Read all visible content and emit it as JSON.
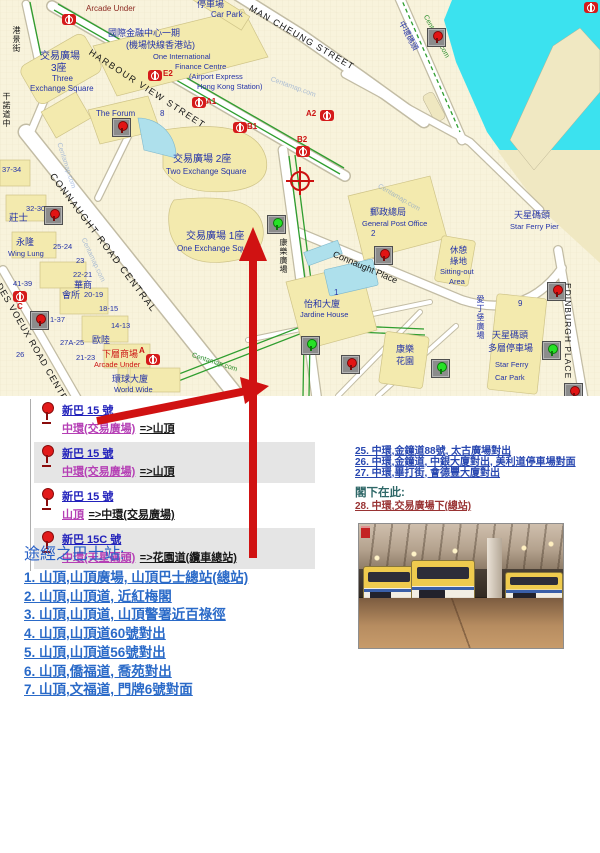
{
  "bus_routes": [
    {
      "route": "新巴 15 號",
      "origin": "中環(交易廣場)",
      "dest": "=>山頂",
      "shaded": false
    },
    {
      "route": "新巴 15 號",
      "origin": "中環(交易廣場)",
      "dest": "=>山頂",
      "shaded": true
    },
    {
      "route": "新巴 15 號",
      "origin": "山頂",
      "dest": "=>中環(交易廣場)",
      "shaded": false
    },
    {
      "route": "新巴 15C 號",
      "origin": "中環(天星碼頭)",
      "dest": "=>花園道(纜車總站)",
      "shaded": true
    }
  ],
  "nearby_stops": {
    "items": [
      "25. 中環,金鐘道88號, 太古廣場對出",
      "26. 中環,金鐘道, 中銀大廈對出, 美利道停車場對面",
      "27. 中環,畢打街, 會德豐大廈對出"
    ],
    "you_are_here_label": "閣下在此:",
    "current_stop": "28. 中環,交易廣場下(總站)"
  },
  "route_stops": {
    "heading": "途經之巴士站:",
    "items": [
      "1. 山頂,山頂廣場, 山頂巴士總站(總站)",
      "2. 山頂,山頂道, 近紅梅閣",
      "3. 山頂,山頂道, 山頂警署近百祿徑",
      "4. 山頂,山頂道60號對出",
      "5. 山頂,山頂道56號對出",
      "6. 山頂,僑福道, 喬苑對出",
      "7. 山頂,文福道, 門牌6號對面"
    ]
  },
  "accent_colors": {
    "arrow_red": "#D01212",
    "link_blue": "#2847B0",
    "visited_magenta": "#B53FB5",
    "current_stop_red": "#993333",
    "water_cyan": "#3BE2EF"
  },
  "map": {
    "labels": [
      {
        "t": "Arcade Under",
        "x": 86,
        "y": 5,
        "s": 8,
        "c": "maroon"
      },
      {
        "t": "停車場",
        "x": 197,
        "y": 0,
        "s": 9
      },
      {
        "t": "Car Park",
        "x": 211,
        "y": 11,
        "s": 8
      },
      {
        "t": "MAN CHEUNG STREET",
        "x": 252,
        "y": 4,
        "s": 9,
        "c": "black",
        "r": 30,
        "ls": 1.2
      },
      {
        "t": "國際金融中心一期",
        "x": 108,
        "y": 29,
        "s": 9
      },
      {
        "t": "(機場快線香港站)",
        "x": 126,
        "y": 41,
        "s": 9
      },
      {
        "t": "One International",
        "x": 153,
        "y": 53,
        "s": 7.5
      },
      {
        "t": "Finance Centre",
        "x": 175,
        "y": 63,
        "s": 7.5
      },
      {
        "t": "(Airport Express",
        "x": 189,
        "y": 73,
        "s": 7.5
      },
      {
        "t": "Hong Kong Station)",
        "x": 197,
        "y": 83,
        "s": 7.5
      },
      {
        "t": "HARBOUR VIEW STREET",
        "x": 92,
        "y": 48,
        "s": 9,
        "c": "black",
        "r": 33,
        "ls": 1.5
      },
      {
        "t": "交易廣場",
        "x": 40,
        "y": 52,
        "s": 10
      },
      {
        "t": "3座",
        "x": 51,
        "y": 64,
        "s": 10
      },
      {
        "t": "Three",
        "x": 52,
        "y": 75,
        "s": 8
      },
      {
        "t": "Exchange Square",
        "x": 30,
        "y": 85,
        "s": 8
      },
      {
        "t": "The Forum",
        "x": 96,
        "y": 110,
        "s": 8
      },
      {
        "t": "8",
        "x": 160,
        "y": 110,
        "s": 8
      },
      {
        "t": "交易廣場 2座",
        "x": 173,
        "y": 155,
        "s": 10
      },
      {
        "t": "Two Exchange Square",
        "x": 166,
        "y": 168,
        "s": 8
      },
      {
        "t": "交易廣場 1座",
        "x": 186,
        "y": 232,
        "s": 10
      },
      {
        "t": "One Exchange Square",
        "x": 177,
        "y": 245,
        "s": 8
      },
      {
        "t": "CONNAUGHT ROAD CENTRAL",
        "x": 55,
        "y": 172,
        "s": 9.5,
        "c": "black",
        "r": 53,
        "ls": 1.5
      },
      {
        "t": "郵政總局",
        "x": 370,
        "y": 208,
        "s": 9
      },
      {
        "t": "General Post Office",
        "x": 362,
        "y": 220,
        "s": 7.5
      },
      {
        "t": "2",
        "x": 371,
        "y": 230,
        "s": 8
      },
      {
        "t": "Connaught Place",
        "x": 335,
        "y": 250,
        "s": 9,
        "c": "black",
        "r": 23
      },
      {
        "t": "休憩",
        "x": 450,
        "y": 246,
        "s": 8.5
      },
      {
        "t": "綠地",
        "x": 450,
        "y": 257,
        "s": 8.5
      },
      {
        "t": "Sitting-out",
        "x": 440,
        "y": 268,
        "s": 7.5
      },
      {
        "t": "Area",
        "x": 449,
        "y": 278,
        "s": 7.5
      },
      {
        "t": "天星碼頭",
        "x": 514,
        "y": 211,
        "s": 9
      },
      {
        "t": "Star Ferry Pier",
        "x": 510,
        "y": 223,
        "s": 7.5
      },
      {
        "t": "怡和大廈",
        "x": 304,
        "y": 300,
        "s": 9
      },
      {
        "t": "Jardine House",
        "x": 300,
        "y": 311,
        "s": 7.5
      },
      {
        "t": "1",
        "x": 334,
        "y": 289,
        "s": 8
      },
      {
        "t": "康樂",
        "x": 396,
        "y": 345,
        "s": 9
      },
      {
        "t": "花園",
        "x": 396,
        "y": 357,
        "s": 9
      },
      {
        "t": "天星碼頭",
        "x": 492,
        "y": 331,
        "s": 9
      },
      {
        "t": "多層停車場",
        "x": 488,
        "y": 344,
        "s": 9
      },
      {
        "t": "Star Ferry",
        "x": 495,
        "y": 361,
        "s": 7.5
      },
      {
        "t": "Car Park",
        "x": 495,
        "y": 374,
        "s": 7.5
      },
      {
        "t": "9",
        "x": 518,
        "y": 300,
        "s": 8
      },
      {
        "t": "EDINBURGH PLACE",
        "x": 572,
        "y": 283,
        "s": 8.5,
        "c": "black",
        "r": 90,
        "ls": 1
      },
      {
        "t": "愛丁堡廣場",
        "x": 476,
        "y": 295,
        "s": 8,
        "v": 1
      },
      {
        "t": "康樂廣場",
        "x": 279,
        "y": 238,
        "s": 8,
        "c": "black",
        "v": 1
      },
      {
        "t": "中環碼頭",
        "x": 404,
        "y": 20,
        "s": 8,
        "r": 62
      },
      {
        "t": "港景街",
        "x": 12,
        "y": 26,
        "s": 8,
        "c": "black",
        "v": 1
      },
      {
        "t": "干諾道中",
        "x": 2,
        "y": 92,
        "s": 8,
        "c": "black",
        "v": 1
      },
      {
        "t": "DES VOEUX ROAD CENTRAL",
        "x": 2,
        "y": 282,
        "s": 9,
        "c": "black",
        "r": 60,
        "ls": 1
      },
      {
        "t": "永隆",
        "x": 16,
        "y": 238,
        "s": 9
      },
      {
        "t": "Wing Lung",
        "x": 8,
        "y": 250,
        "s": 7.5
      },
      {
        "t": "莊士",
        "x": 9,
        "y": 214,
        "s": 9.5
      },
      {
        "t": "37-34",
        "x": 2,
        "y": 166,
        "s": 7.5
      },
      {
        "t": "32-30",
        "x": 26,
        "y": 205,
        "s": 7.5
      },
      {
        "t": "25-24",
        "x": 53,
        "y": 243,
        "s": 7.5
      },
      {
        "t": "23",
        "x": 76,
        "y": 257,
        "s": 7.5
      },
      {
        "t": "22-21",
        "x": 73,
        "y": 271,
        "s": 7.5
      },
      {
        "t": "41-39",
        "x": 13,
        "y": 280,
        "s": 7.5
      },
      {
        "t": "20-19",
        "x": 84,
        "y": 291,
        "s": 7.5
      },
      {
        "t": "18-15",
        "x": 99,
        "y": 305,
        "s": 7.5
      },
      {
        "t": "14-13",
        "x": 111,
        "y": 322,
        "s": 7.5
      },
      {
        "t": "27A-25",
        "x": 60,
        "y": 339,
        "s": 7.5
      },
      {
        "t": "21-23",
        "x": 76,
        "y": 354,
        "s": 7.5
      },
      {
        "t": "26",
        "x": 16,
        "y": 351,
        "s": 7.5
      },
      {
        "t": "1-37",
        "x": 50,
        "y": 316,
        "s": 7.5
      },
      {
        "t": "華商",
        "x": 74,
        "y": 281,
        "s": 9
      },
      {
        "t": "會所",
        "x": 62,
        "y": 291,
        "s": 9
      },
      {
        "t": "歐陸",
        "x": 92,
        "y": 336,
        "s": 9
      },
      {
        "t": "下層商場",
        "x": 102,
        "y": 350,
        "s": 9,
        "c": "red"
      },
      {
        "t": "Arcade Under",
        "x": 94,
        "y": 361,
        "s": 7.5,
        "c": "red"
      },
      {
        "t": "環球大廈",
        "x": 112,
        "y": 375,
        "s": 9
      },
      {
        "t": "World Wide",
        "x": 114,
        "y": 386,
        "s": 7.5
      },
      {
        "t": "E2",
        "x": 163,
        "y": 70,
        "s": 8,
        "c": "exit",
        "b": 1
      },
      {
        "t": "A1",
        "x": 206,
        "y": 98,
        "s": 8,
        "c": "exit",
        "b": 1
      },
      {
        "t": "B1",
        "x": 247,
        "y": 123,
        "s": 8,
        "c": "exit",
        "b": 1
      },
      {
        "t": "A2",
        "x": 306,
        "y": 110,
        "s": 8,
        "c": "exit",
        "b": 1
      },
      {
        "t": "B2",
        "x": 297,
        "y": 136,
        "s": 8,
        "c": "exit",
        "b": 1
      },
      {
        "t": "C",
        "x": 17,
        "y": 303,
        "s": 8,
        "c": "exit",
        "b": 1
      },
      {
        "t": "A",
        "x": 139,
        "y": 347,
        "s": 8,
        "c": "exit",
        "b": 1
      },
      {
        "t": "Centamap.com",
        "x": 62,
        "y": 142,
        "s": 7,
        "c": "wm",
        "r": 72
      },
      {
        "t": "Centamap.com",
        "x": 272,
        "y": 76,
        "s": 7,
        "c": "wm",
        "r": 20
      },
      {
        "t": "Centamap.com",
        "x": 380,
        "y": 183,
        "s": 7,
        "c": "wm",
        "r": 30
      },
      {
        "t": "Centamap.com",
        "x": 86,
        "y": 237,
        "s": 7,
        "c": "wm",
        "r": 65
      },
      {
        "t": "Centamap.com",
        "x": 193,
        "y": 352,
        "s": 7,
        "c": "green",
        "r": 18
      },
      {
        "t": "Centamap.com",
        "x": 428,
        "y": 14,
        "s": 7,
        "c": "green",
        "r": 62
      }
    ],
    "markers": [
      {
        "x": 112,
        "y": 118,
        "k": "red"
      },
      {
        "x": 44,
        "y": 206,
        "k": "red"
      },
      {
        "x": 30,
        "y": 311,
        "k": "red"
      },
      {
        "x": 427,
        "y": 28,
        "k": "red"
      },
      {
        "x": 374,
        "y": 246,
        "k": "red"
      },
      {
        "x": 341,
        "y": 355,
        "k": "red"
      },
      {
        "x": 547,
        "y": 282,
        "k": "red"
      },
      {
        "x": 564,
        "y": 383,
        "k": "red"
      },
      {
        "x": 267,
        "y": 215,
        "k": "green"
      },
      {
        "x": 301,
        "y": 336,
        "k": "green"
      },
      {
        "x": 431,
        "y": 359,
        "k": "green"
      },
      {
        "x": 542,
        "y": 341,
        "k": "green"
      }
    ],
    "mtr_logos": [
      {
        "x": 62,
        "y": 14
      },
      {
        "x": 148,
        "y": 70
      },
      {
        "x": 192,
        "y": 97
      },
      {
        "x": 233,
        "y": 122
      },
      {
        "x": 320,
        "y": 110
      },
      {
        "x": 296,
        "y": 146
      },
      {
        "x": 13,
        "y": 291
      },
      {
        "x": 146,
        "y": 354
      },
      {
        "x": 584,
        "y": 2
      }
    ]
  }
}
